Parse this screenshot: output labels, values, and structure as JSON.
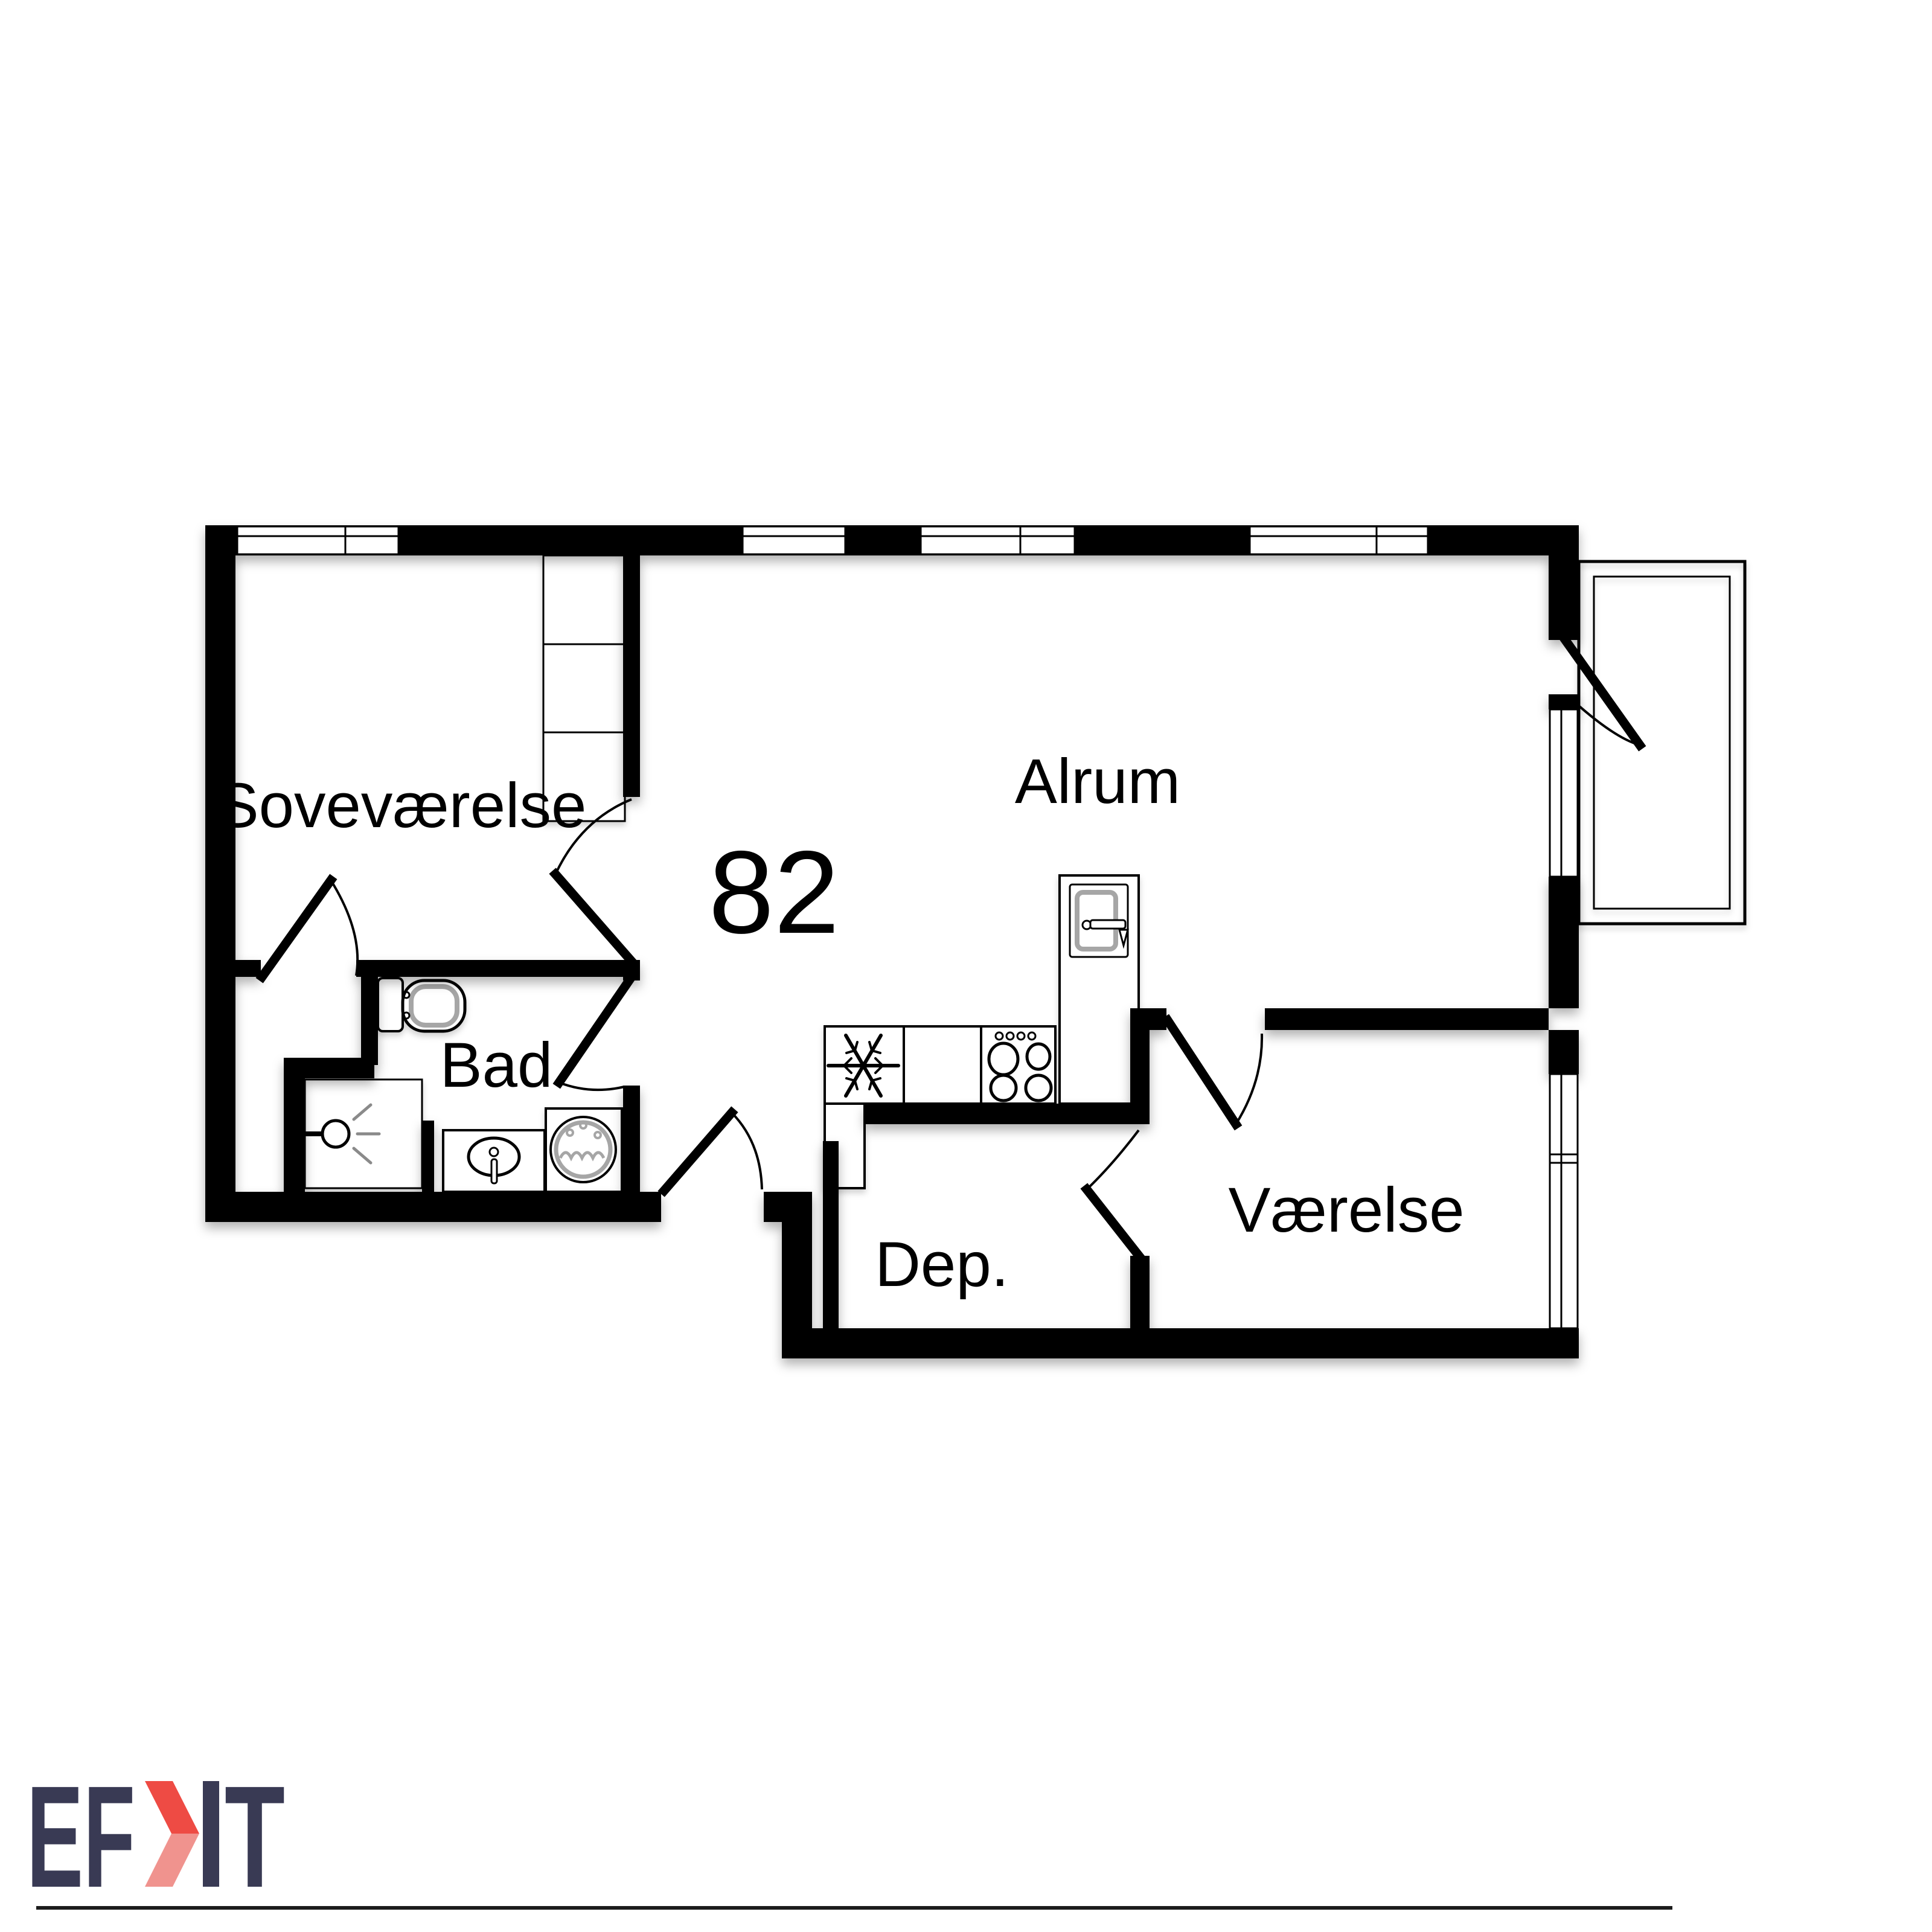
{
  "plan": {
    "area_number": "82",
    "rooms": {
      "sovevaerelse": "Soveværelse",
      "alrum": "Alrum",
      "bad": "Bad",
      "dep": "Dep.",
      "vaerelse": "Værelse"
    },
    "fixture_icons": {
      "fridge": "snowflake-icon",
      "stove": "stove-burners-icon",
      "island_sink": "kitchen-sink-icon",
      "toilet": "toilet-icon",
      "shower": "shower-head-icon",
      "bath_sink": "washbasin-icon",
      "washer": "washing-machine-icon",
      "wardrobe": "wardrobe-cabinet",
      "balcony": "balcony-outline"
    }
  },
  "footer": {
    "logo_ef": "EF",
    "logo_t": "T",
    "disclaimer": "Vejledende tegning uden ansvar",
    "colors": {
      "navy": "#393a54",
      "red": "#ee4b44",
      "red_light": "#f0938e",
      "wall_black": "#000000",
      "fixture_gray": "#a6a6a6"
    }
  }
}
